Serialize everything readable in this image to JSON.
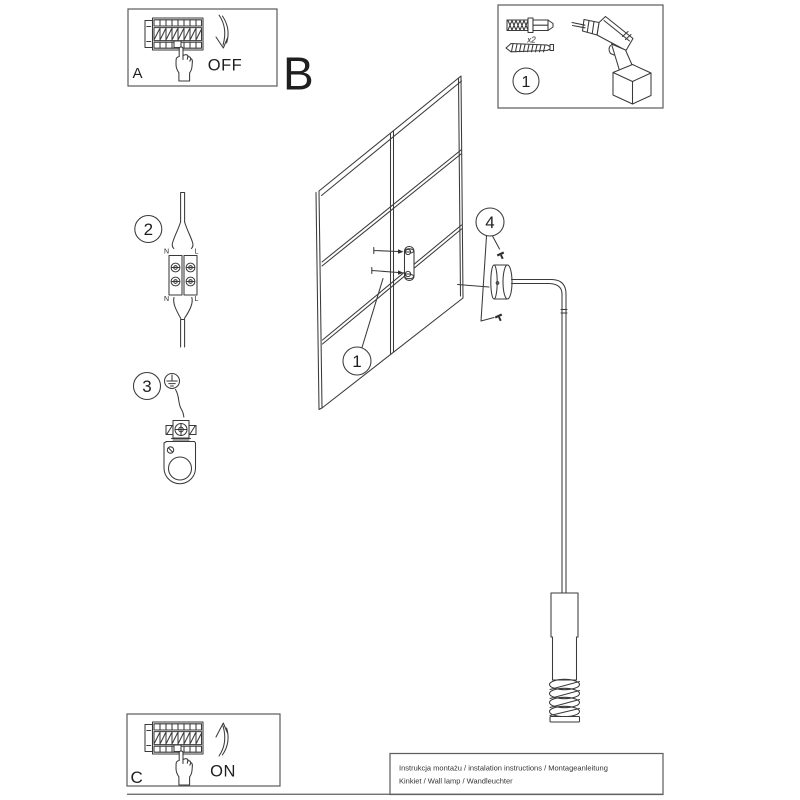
{
  "colors": {
    "ink": "#2e2e2e",
    "frame": "#606060",
    "background": "#ffffff"
  },
  "steps": {
    "power_off": {
      "label": "A",
      "state": "OFF"
    },
    "install_view": {
      "label": "B"
    },
    "power_on": {
      "label": "C",
      "state": "ON"
    },
    "kit": {
      "marker": "1",
      "anchor_qty": "x2"
    },
    "wiring": {
      "marker": "2",
      "labels": {
        "n_top": "N",
        "l_top": "L",
        "n_bottom": "N",
        "l_bottom": "L"
      }
    },
    "bracket": {
      "marker": "3"
    },
    "wall_marker": "1",
    "lamp_marker": "4"
  },
  "icons": [
    "breaker-panel",
    "pointing-hand",
    "curved-arrow",
    "wall-anchor",
    "mounting-screw",
    "drill",
    "terminal-connector",
    "ground-symbol",
    "mounting-bracket",
    "wall-grid",
    "wall-lamp"
  ],
  "footer": {
    "line1": "Instrukcja montażu / instalation instructions / Montageanleitung",
    "line2": "Kinkiet / Wall lamp / Wandleuchter"
  }
}
